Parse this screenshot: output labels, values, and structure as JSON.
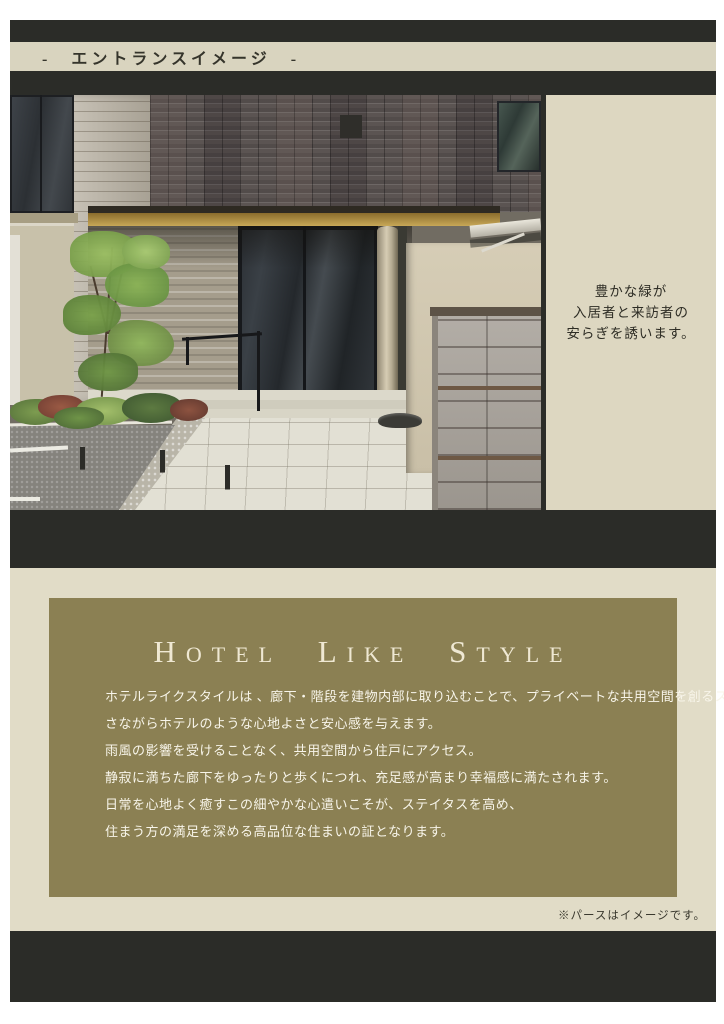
{
  "header": {
    "title": "-　エントランスイメージ　-"
  },
  "hero": {
    "caption": [
      "豊かな緑が",
      "入居者と来訪者の",
      "安らぎを誘います。"
    ]
  },
  "main": {
    "title": "Hotel Like Style",
    "paragraphs": [
      "ホテルライクスタイルは 、廊下・階段を建物内部に取り込むことで、プライベートな共用空間を創るスタイル。",
      "さながらホテルのような心地よさと安心感を与えます。",
      "雨風の影響を受けることなく、共用空間から住戸にアクセス。",
      "静寂に満ちた廊下をゆったりと歩くにつれ、充足感が高まり幸福感に満たされます。",
      "日常を心地よく癒すこの細やかな心遣いこそが、ステイタスを高め、",
      "住まう方の満足を深める高品位な住まいの証となります。"
    ],
    "footnote": "※パースはイメージです。"
  },
  "colors": {
    "charcoal": "#2b2c28",
    "header_cream": "#d9d4bf",
    "panel_beige": "#ddd7c1",
    "lower_cream": "#e1dcc7",
    "olive": "#8b8053",
    "title_cream": "#efe8d3"
  }
}
